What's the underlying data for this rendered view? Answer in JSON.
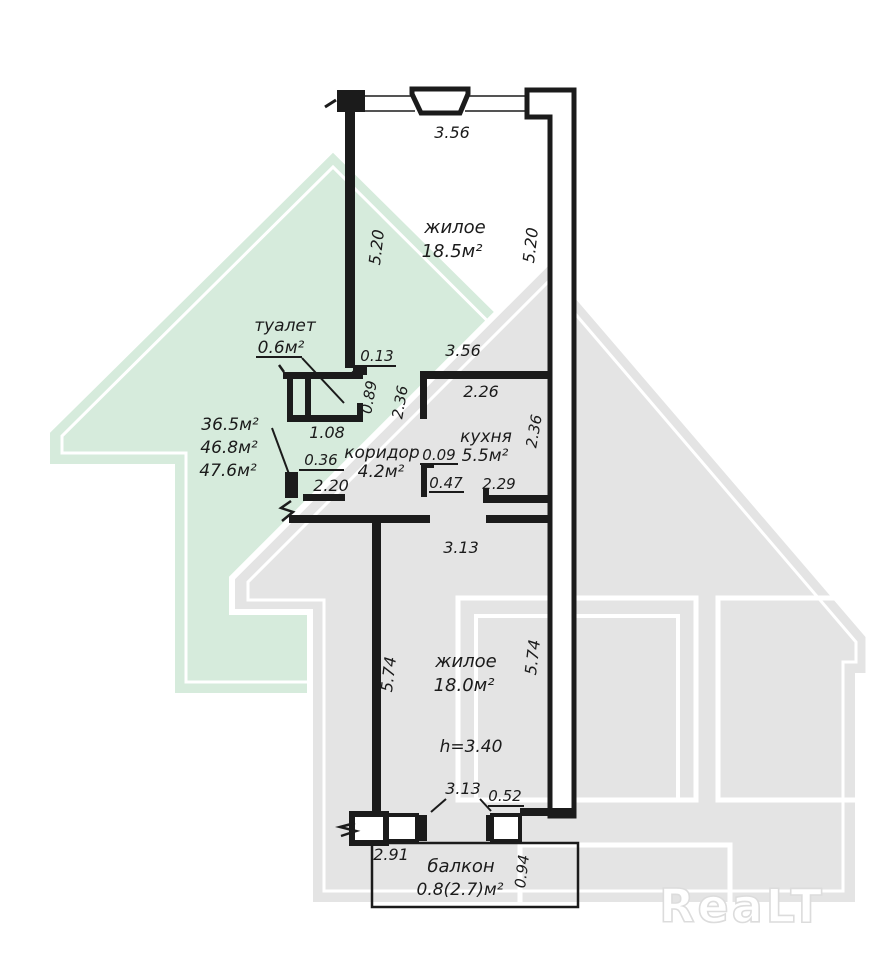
{
  "watermark": {
    "logo": "ReaLT"
  },
  "colors": {
    "green_house": "#d6ebdc",
    "gray_house": "#e4e4e4",
    "ink": "#1b1b1b"
  },
  "totals": {
    "line1": "36.5м²",
    "line2": "46.8м²",
    "line3": "47.6м²"
  },
  "rooms": {
    "living_top": {
      "name": "жилое",
      "area": "18.5м²"
    },
    "toilet": {
      "name": "туалет",
      "area": "0.6м²"
    },
    "corridor": {
      "name": "коридор",
      "area": "4.2м²"
    },
    "kitchen": {
      "name": "кухня",
      "area": "5.5м²"
    },
    "living_bottom": {
      "name": "жилое",
      "area": "18.0м²",
      "height_note": "h=3.40"
    },
    "balcony": {
      "name": "балкон",
      "area": "0.8(2.7)м²"
    }
  },
  "dims": {
    "win_top": "3.56",
    "living_top_left": "5.20",
    "living_top_right": "5.20",
    "wall_step": "0.13",
    "span_mid": "3.56",
    "kitchen_top": "2.26",
    "toilet_right": "0.89",
    "corridor_v": "2.36",
    "kitchen_v": "2.36",
    "toilet_w": "1.08",
    "entry_stub": "0.36",
    "entry_w": "2.20",
    "stub_009": "0.09",
    "stub_047": "0.47",
    "kitchen_bottom": "2.29",
    "room2_top": "3.13",
    "room2_left": "5.74",
    "room2_right": "5.74",
    "balcony_span": "3.13",
    "stub_052": "0.52",
    "balcony_left": "2.91",
    "balcony_right": "0.94"
  }
}
